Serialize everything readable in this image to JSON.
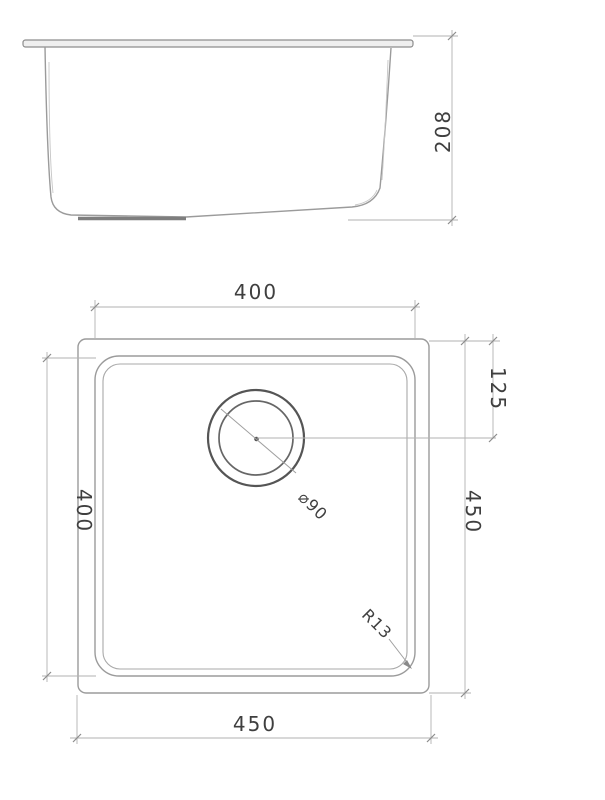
{
  "drawing": {
    "type": "technical-drawing",
    "subject": "undermount-sink",
    "colors": {
      "background": "#ffffff",
      "drawing_line": "#9b9b9b",
      "dimension_line": "#b2b2b2",
      "text": "#3f3f3f"
    },
    "side_view": {
      "depth_label": "208"
    },
    "plan_view": {
      "top_width_label": "400",
      "left_height_label": "400",
      "right_height_label": "450",
      "bottom_width_label": "450",
      "drain_offset_label": "125",
      "drain_diameter_label": "⌀90",
      "corner_radius_label": "R13"
    }
  }
}
